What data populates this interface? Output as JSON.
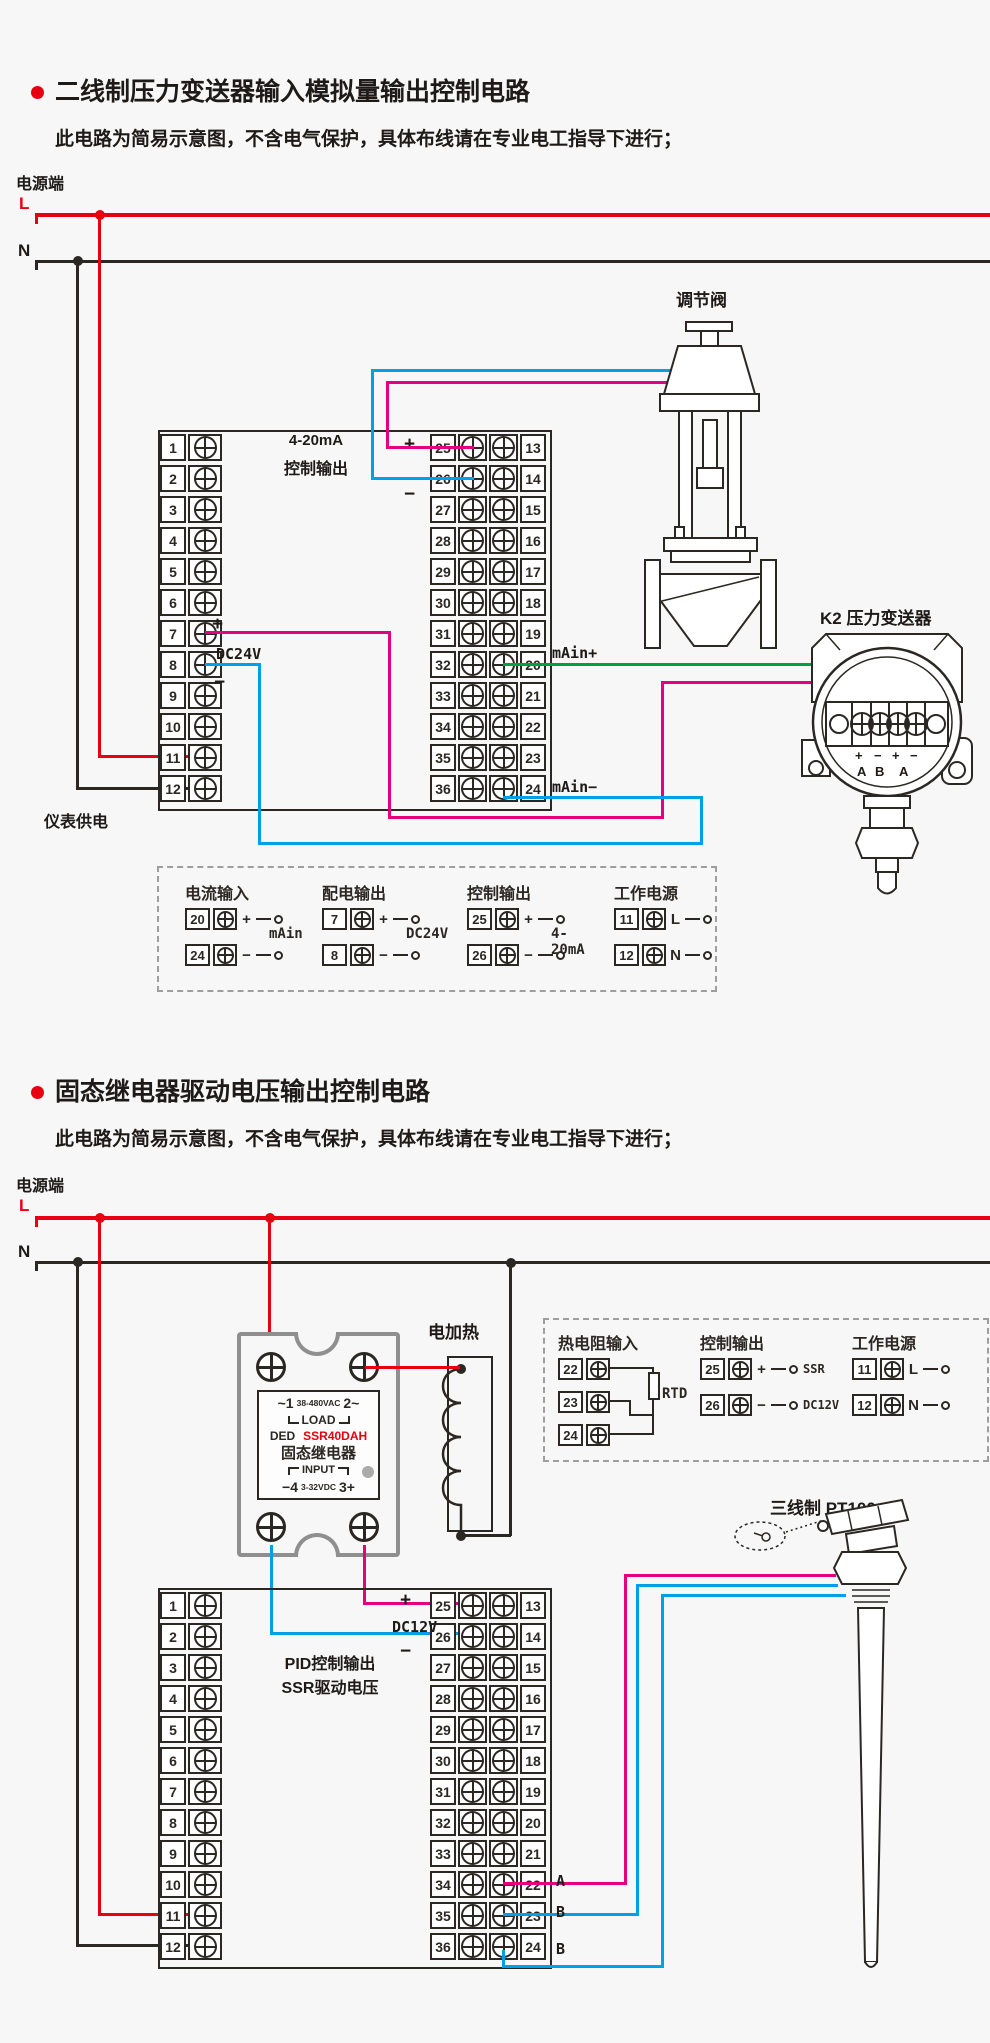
{
  "colors": {
    "red": "#e60012",
    "dark": "#2b2723",
    "cyan": "#00a0e9",
    "magenta": "#e5007e",
    "green": "#00a04b",
    "gray": "#8f8f8f",
    "background": "#f7f7f7"
  },
  "s1": {
    "title": "二线制压力变送器输入模拟量输出控制电路",
    "subtitle": "此电路为简易示意图，不含电气保护，具体布线请在专业电工指导下进行；",
    "power": "电源端",
    "l": "L",
    "n": "N",
    "valve_label": "调节阀",
    "transmitter_label": "K2 压力变送器",
    "output_line1": "4-20mA",
    "output_line2": "控制输出",
    "plus": "+",
    "minus": "−",
    "dc24v": "DC24V",
    "supply_label": "仪表供电",
    "main_plus": "mAin+",
    "main_minus": "mAin−",
    "left_terminals": [
      1,
      2,
      3,
      4,
      5,
      6,
      7,
      8,
      9,
      10,
      11,
      12
    ],
    "strip_left": [
      25,
      26,
      27,
      28,
      29,
      30,
      31,
      32,
      33,
      34,
      35,
      36
    ],
    "strip_right": [
      13,
      14,
      15,
      16,
      17,
      18,
      19,
      20,
      21,
      22,
      23,
      24
    ],
    "xmtr_signs": [
      "+",
      "−",
      "+",
      "−"
    ],
    "xmtr_terms": [
      "A",
      "B",
      "A"
    ],
    "legend_groups": [
      {
        "title": "电流输入",
        "mid": "mAin",
        "rows": [
          [
            "20",
            "+"
          ],
          [
            "24",
            "−"
          ]
        ]
      },
      {
        "title": "配电输出",
        "mid": "DC24V",
        "rows": [
          [
            "7",
            "+"
          ],
          [
            "8",
            "−"
          ]
        ]
      },
      {
        "title": "控制输出",
        "mid": "4-20mA",
        "rows": [
          [
            "25",
            "+"
          ],
          [
            "26",
            "−"
          ]
        ]
      },
      {
        "title": "工作电源",
        "mid": "",
        "rows": [
          [
            "11",
            "L"
          ],
          [
            "12",
            "N"
          ]
        ]
      }
    ]
  },
  "s2": {
    "title": "固态继电器驱动电压输出控制电路",
    "subtitle": "此电路为简易示意图，不含电气保护，具体布线请在专业电工指导下进行；",
    "power": "电源端",
    "l": "L",
    "n": "N",
    "heater_label": "电加热",
    "ssr": {
      "ac_left": "~1",
      "ac_mid": "38-480VAC",
      "ac_right": "2~",
      "load": "LOAD",
      "brand": "DED",
      "model": "SSR40DAH",
      "name": "固态继电器",
      "input": "INPUT",
      "dc_left": "−4",
      "dc_mid": "3-32VDC",
      "dc_right": "3+"
    },
    "pid_line1": "PID控制输出",
    "pid_line2": "SSR驱动电压",
    "dc12v": "DC12V",
    "plus": "+",
    "minus": "−",
    "pt100_label": "三线制 PT100",
    "wire_a": "A",
    "wire_b1": "B",
    "wire_b2": "B",
    "left_terminals": [
      1,
      2,
      3,
      4,
      5,
      6,
      7,
      8,
      9,
      10,
      11,
      12
    ],
    "strip_left": [
      25,
      26,
      27,
      28,
      29,
      30,
      31,
      32,
      33,
      34,
      35,
      36
    ],
    "strip_right": [
      13,
      14,
      15,
      16,
      17,
      18,
      19,
      20,
      21,
      22,
      23,
      24
    ],
    "legend_groups": [
      {
        "title": "热电阻输入",
        "mid": "RTD",
        "rows": [
          [
            "22",
            ""
          ],
          [
            "23",
            ""
          ],
          [
            "24",
            ""
          ]
        ]
      },
      {
        "title": "控制输出",
        "mid": "",
        "rows": [
          [
            "25",
            "+",
            "SSR"
          ],
          [
            "26",
            "−",
            "DC12V"
          ]
        ]
      },
      {
        "title": "工作电源",
        "mid": "",
        "rows": [
          [
            "11",
            "L"
          ],
          [
            "12",
            "N"
          ]
        ]
      }
    ]
  }
}
